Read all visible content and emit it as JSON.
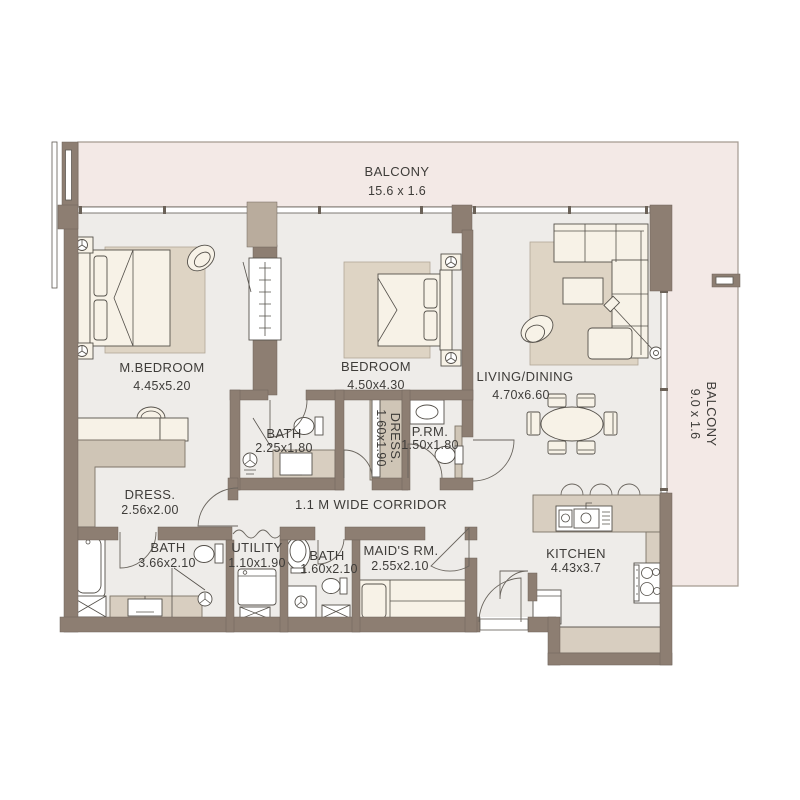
{
  "plan_title": "Apartment Floor Plan",
  "colors": {
    "background": "#ffffff",
    "wall": "#8d7e72",
    "wall_column": "#b9ac9d",
    "balcony_fill": "#f3e9e6",
    "floor_fill": "#eeece9",
    "rug_fill": "#ded4c4",
    "counter_fill": "#d8cec0",
    "wardrobe_fill": "#cfc5b6",
    "furniture_fill": "#f7f2e7",
    "fixture_fill": "#ffffff",
    "text": "#3e3c39"
  },
  "balconies": {
    "top": {
      "label": "BALCONY",
      "dims": "15.6 x 1.6"
    },
    "right": {
      "label": "BALCONY",
      "dims": "9.0 x 1.6"
    }
  },
  "rooms": {
    "m_bedroom": {
      "label": "M.BEDROOM",
      "dims": "4.45x5.20"
    },
    "bedroom": {
      "label": "BEDROOM",
      "dims": "4.50x4.30"
    },
    "living_dining": {
      "label": "LIVING/DINING",
      "dims": "4.70x6.60"
    },
    "master_bath": {
      "label": "BATH",
      "dims": "2.25x1.80"
    },
    "dress_small": {
      "label": "DRESS.",
      "dims": "1.60x1.90"
    },
    "powder_room": {
      "label": "P.RM.",
      "dims": "1.50x1.80"
    },
    "dress_master": {
      "label": "DRESS.",
      "dims": "2.56x2.00"
    },
    "corridor": {
      "label": "1.1 M WIDE CORRIDOR"
    },
    "family_bath": {
      "label": "BATH",
      "dims": "3.66x2.10"
    },
    "utility": {
      "label": "UTILITY",
      "dims": "1.10x1.90"
    },
    "maid_bath": {
      "label": "BATH",
      "dims": "1.60x2.10"
    },
    "maids_room": {
      "label": "MAID'S RM.",
      "dims": "2.55x2.10"
    },
    "kitchen": {
      "label": "KITCHEN",
      "dims": "4.43x3.7"
    }
  }
}
